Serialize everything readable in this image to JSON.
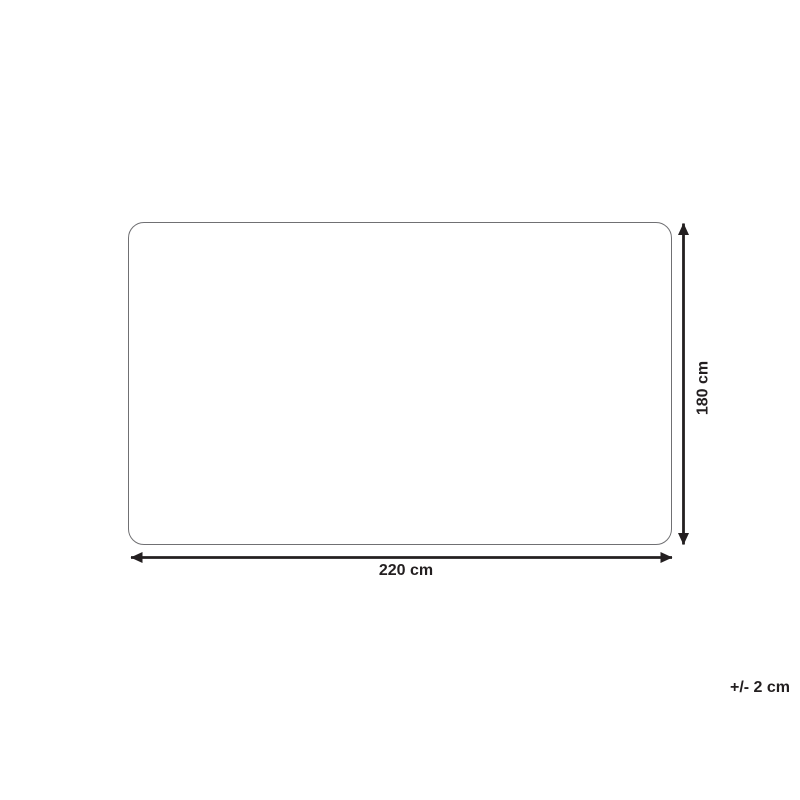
{
  "diagram": {
    "type": "product-dimension-drawing",
    "shape": "rounded-rectangle",
    "width_label": "220 cm",
    "height_label": "180 cm",
    "tolerance_label": "+/- 2 cm",
    "dimensions": {
      "width_cm": 220,
      "height_cm": 180,
      "tolerance_cm": 2
    },
    "colors": {
      "background": "#ffffff",
      "outline": "#707073",
      "arrow": "#231f20",
      "ink": "#231f20"
    }
  }
}
